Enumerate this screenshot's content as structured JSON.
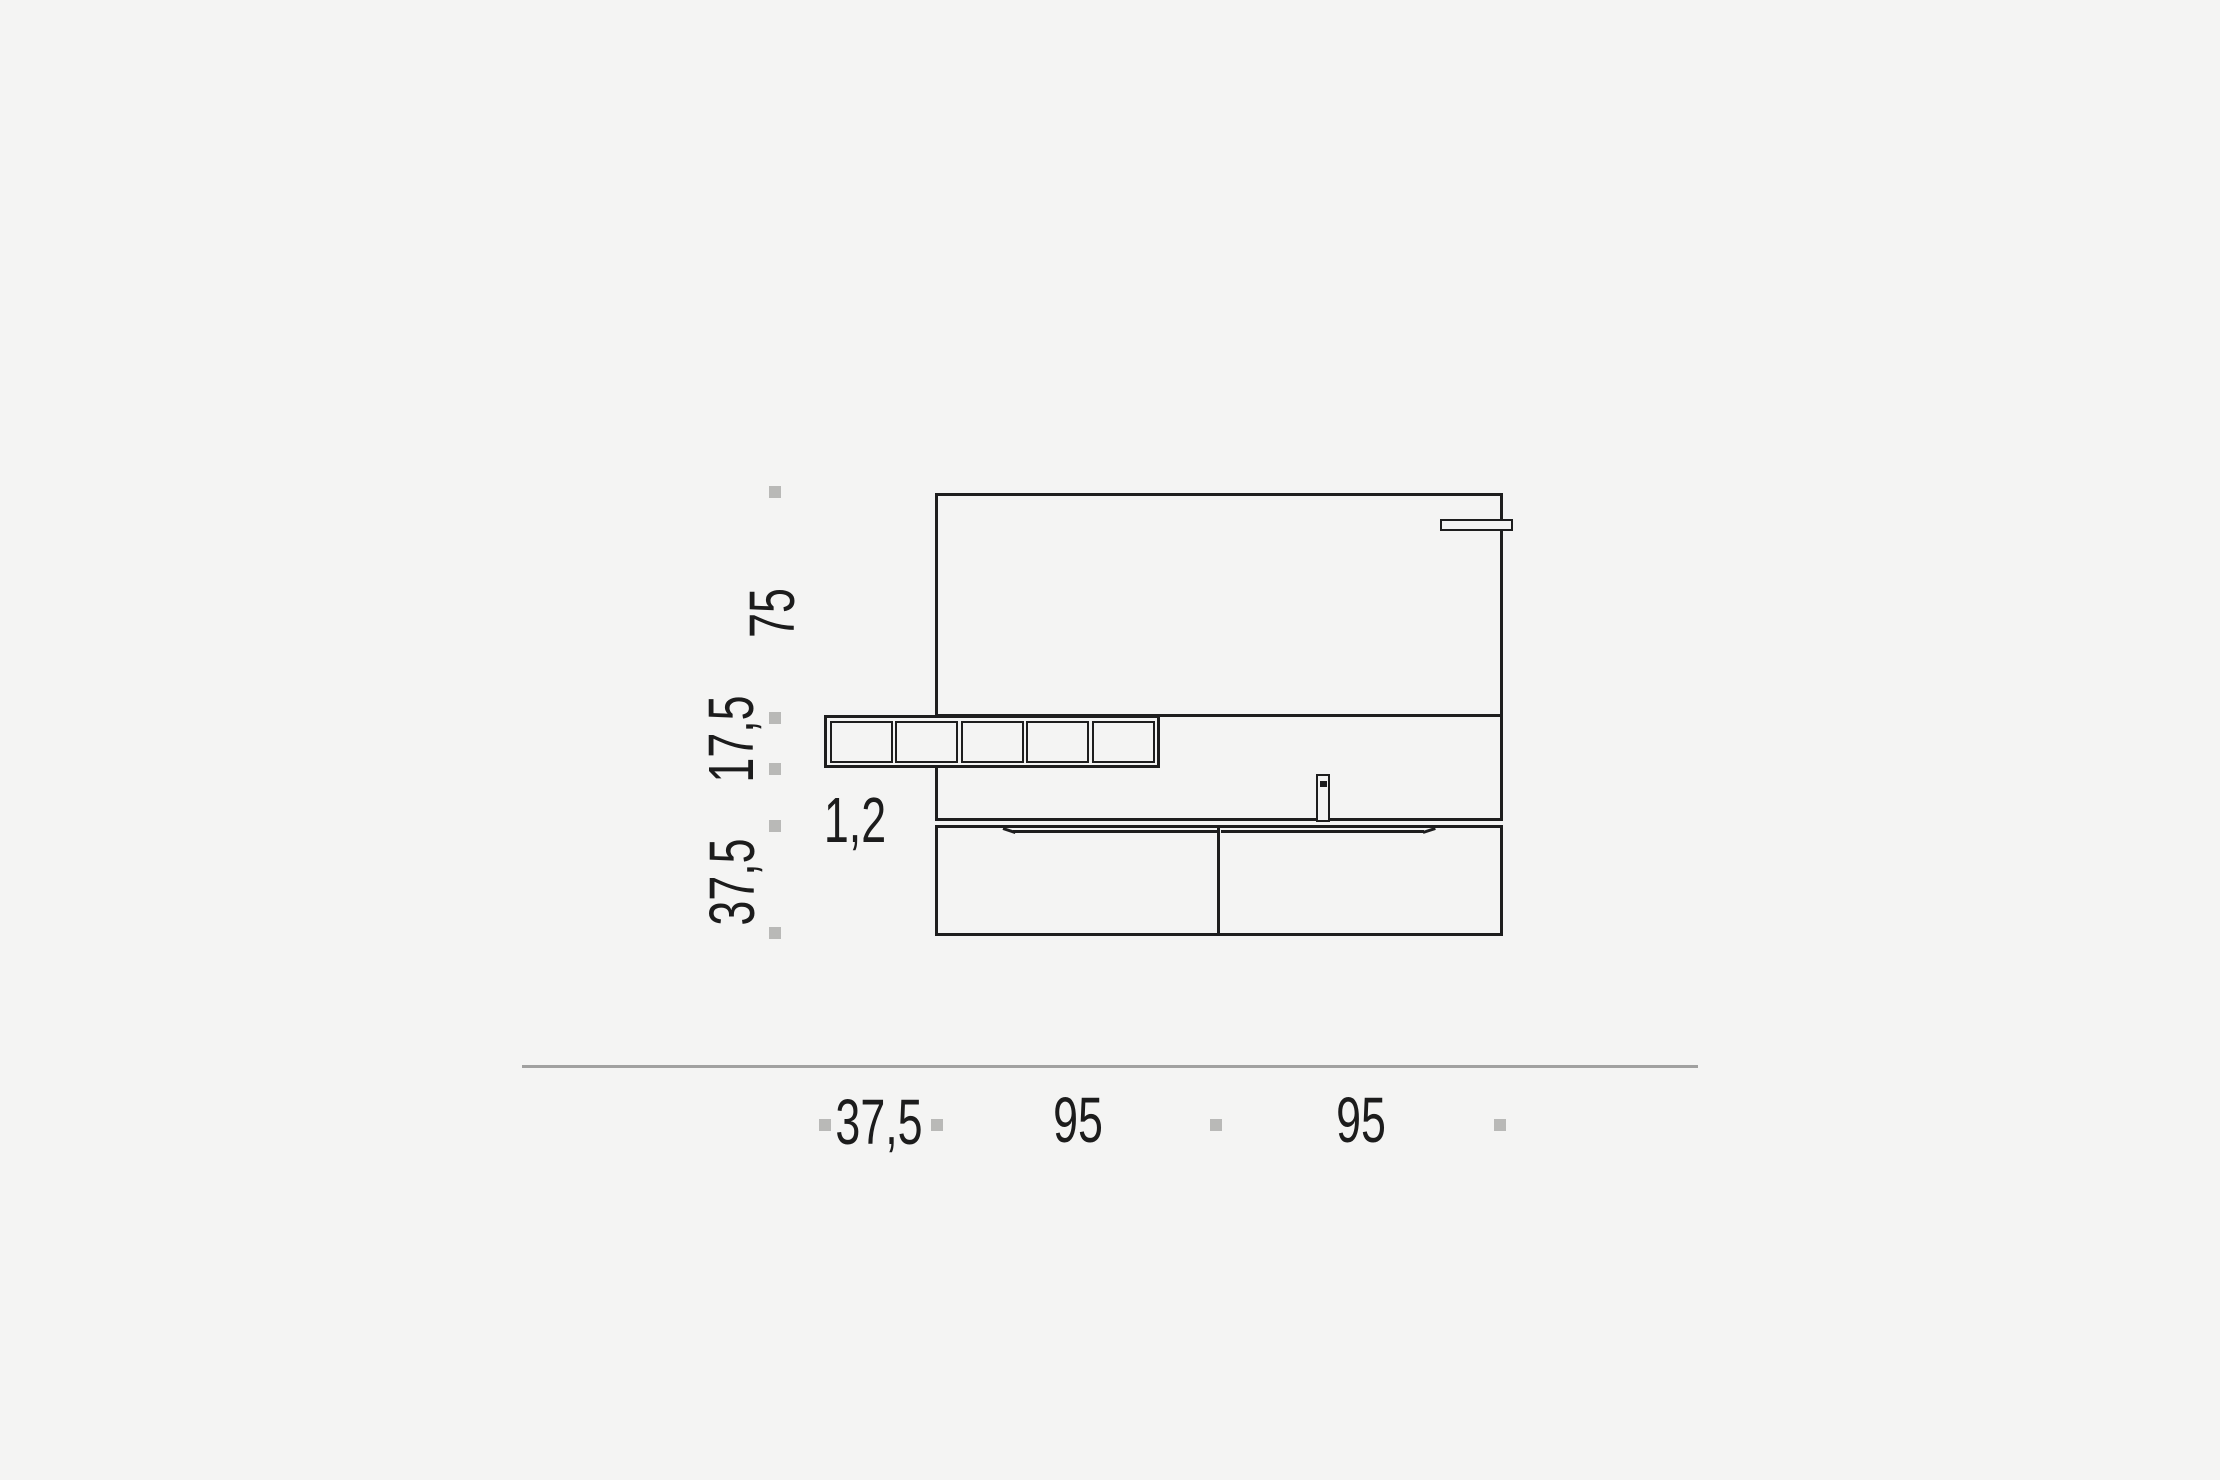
{
  "page": {
    "background_color": "#f4f4f3"
  },
  "drawing": {
    "name": "vanity-elevation",
    "description": "Front elevation technical drawing of a wall-hung bathroom vanity: mirror panel with light bar, row of five open shelf compartments, countertop with faucet, and a two-drawer base unit above a ground baseline",
    "line_color": "#1e1e1e",
    "tick_color": "#b9b9b7",
    "baseline_color": "#a1a1a0",
    "text_color": "#1c1c1c",
    "shelf_compartment_count": 5
  },
  "dimensions": {
    "vertical": {
      "mirror_height": "75",
      "shelf_height": "17,5",
      "counter_thickness": "1,2",
      "cabinet_height": "37,5"
    },
    "horizontal": {
      "shelf_overhang": "37,5",
      "left_module": "95",
      "right_module": "95"
    }
  }
}
